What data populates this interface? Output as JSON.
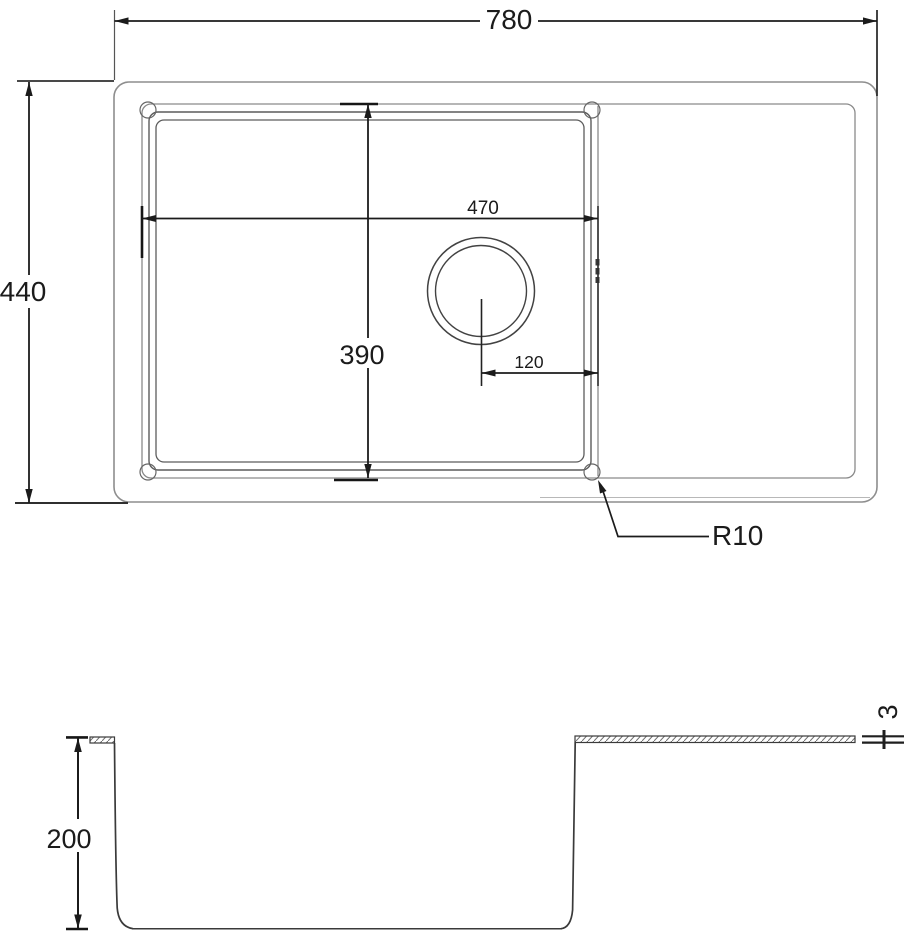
{
  "top_view": {
    "overall_width": "780",
    "overall_depth": "440",
    "bowl_width": "470",
    "bowl_depth": "390",
    "drain_offset_from_bowl_edge": "120",
    "bowl_corner_radius": "R10"
  },
  "section_view": {
    "bowl_inner_depth": "200",
    "top_edge_thickness": "3"
  },
  "colors": {
    "dimension_line": "#1b1b1b",
    "outline_light": "#8e8e8e",
    "outline_dark": "#3a3a3a",
    "background": "#ffffff"
  }
}
